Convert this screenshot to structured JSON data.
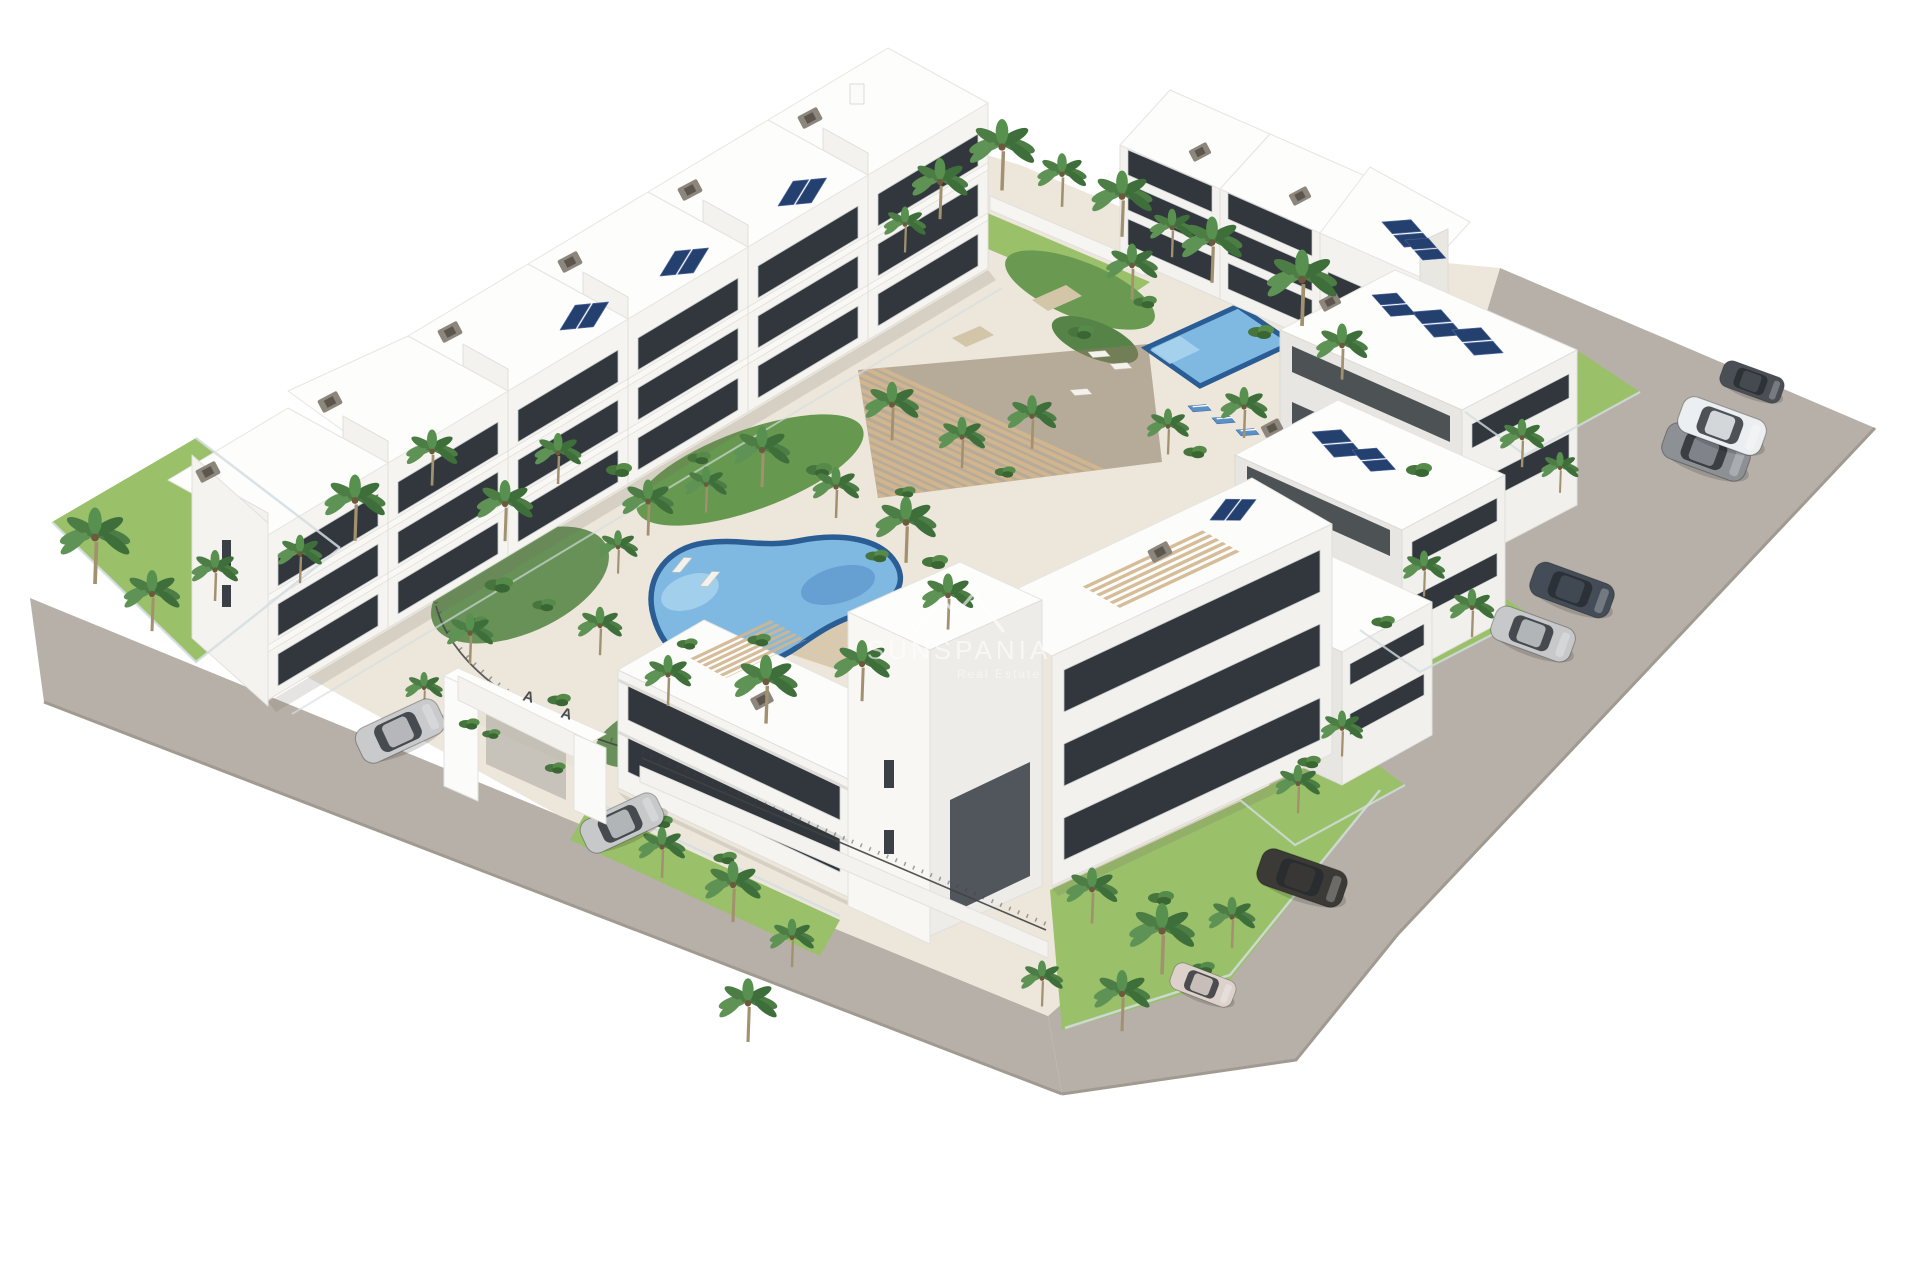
{
  "image": {
    "kind": "3d-architectural-render",
    "subject": "Aerial view of a white modern apartment complex with courtyard pools, palm trees, rooftop terraces, perimeter roads and parked cars",
    "width": 1920,
    "height": 1280
  },
  "watermark": {
    "logo": "mountain-peaks-icon",
    "brand": "SUNSPANIA",
    "tagline": "Real Estate"
  },
  "entrance_gate": {
    "marks": [
      "A",
      "A"
    ]
  },
  "palette": {
    "background": "#ffffff",
    "road": "#b7b0a8",
    "road_edge": "#a19a91",
    "pavement": "#ece6db",
    "building_white": "#fbfbfa",
    "building_shade": "#e9e8e3",
    "window_glass": "#31373c",
    "lawn": "#9ac069",
    "foliage": "#4c7d44",
    "pool_water": "#7fb9e2",
    "pool_rim": "#2a5d94",
    "pergola_wood": "#d2b68e",
    "deck_wood": "#dcc9a6",
    "solar_panel": "#23406e",
    "fence_dark": "#434343",
    "glass_fence": "#d3dde0",
    "watermark_color": "#ffffff"
  },
  "scene": {
    "pools": [
      {
        "name": "freeform-lagoon-pool",
        "shape": "freeform"
      },
      {
        "name": "rectangular-lap-pool",
        "shape": "rectangular"
      }
    ],
    "roads": [
      {
        "name": "south-access-road"
      },
      {
        "name": "east-access-road"
      }
    ],
    "buildings": [
      {
        "name": "west-wing-apartments",
        "floors": 3
      },
      {
        "name": "north-wing-apartments",
        "floors": 3
      },
      {
        "name": "east-wing-apartments",
        "floors": 3
      },
      {
        "name": "south-block-apartments",
        "floors": 3
      }
    ],
    "features": [
      "rooftop-terraces",
      "solar-panels",
      "wood-pergola",
      "sun-loungers",
      "entrance-gate",
      "garden-fences"
    ],
    "cars": [
      {
        "name": "silver-suv",
        "color": "#c9cacc",
        "location": "south-road"
      },
      {
        "name": "silver-sedan",
        "color": "#c6c8ca",
        "location": "south-road"
      },
      {
        "name": "white-hatchback",
        "color": "#ddd2cb",
        "location": "south-east-corner"
      },
      {
        "name": "dark-suv",
        "color": "#3b3a36",
        "location": "east-road"
      },
      {
        "name": "dark-sedan",
        "color": "#444c57",
        "location": "east-road"
      },
      {
        "name": "silver-sedan-2",
        "color": "#c6c8ca",
        "location": "east-road"
      },
      {
        "name": "grey-suv",
        "color": "#8d9196",
        "location": "east-road"
      },
      {
        "name": "white-suv",
        "color": "#eceff1",
        "location": "east-road"
      },
      {
        "name": "dark-hatchback",
        "color": "#4a4f55",
        "location": "east-road"
      }
    ],
    "vegetation": {
      "palm_trees": 48,
      "shrubs": 24,
      "lawns": 6
    }
  }
}
